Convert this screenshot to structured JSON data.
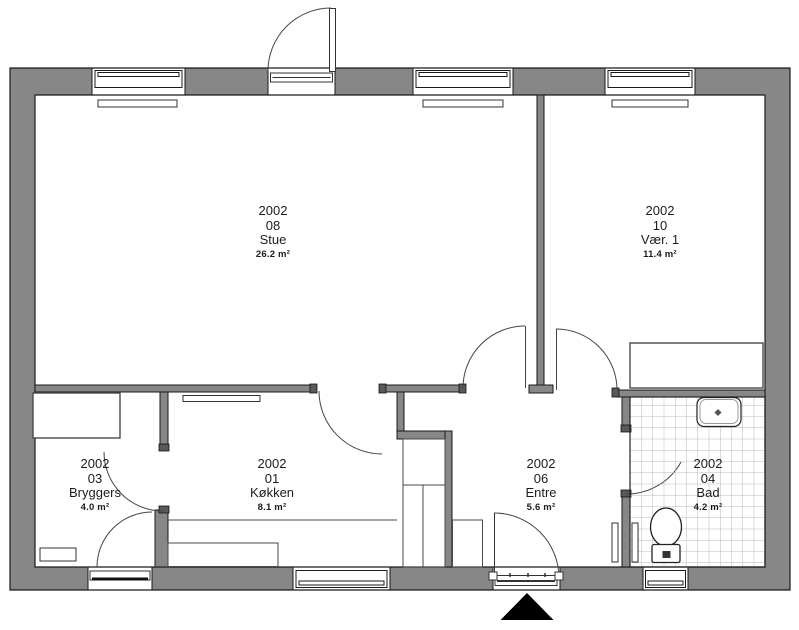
{
  "plan": {
    "title": "Floor plan building 2002",
    "colors": {
      "wall": "#878787",
      "outline": "#1a1a1a",
      "tile_line": "#b9b9b9",
      "floor": "#ffffff",
      "marker": "#000000"
    },
    "entrance_marker": "filled triangle pointing up at main entrance"
  },
  "rooms": [
    {
      "building": "2002",
      "number": "08",
      "name": "Stue",
      "area": "26.2 m²"
    },
    {
      "building": "2002",
      "number": "10",
      "name": "Vær. 1",
      "area": "11.4 m²"
    },
    {
      "building": "2002",
      "number": "03",
      "name": "Bryggers",
      "area": "4.0 m²"
    },
    {
      "building": "2002",
      "number": "01",
      "name": "Køkken",
      "area": "8.1 m²"
    },
    {
      "building": "2002",
      "number": "06",
      "name": "Entre",
      "area": "5.6 m²"
    },
    {
      "building": "2002",
      "number": "04",
      "name": "Bad",
      "area": "4.2 m²"
    }
  ]
}
